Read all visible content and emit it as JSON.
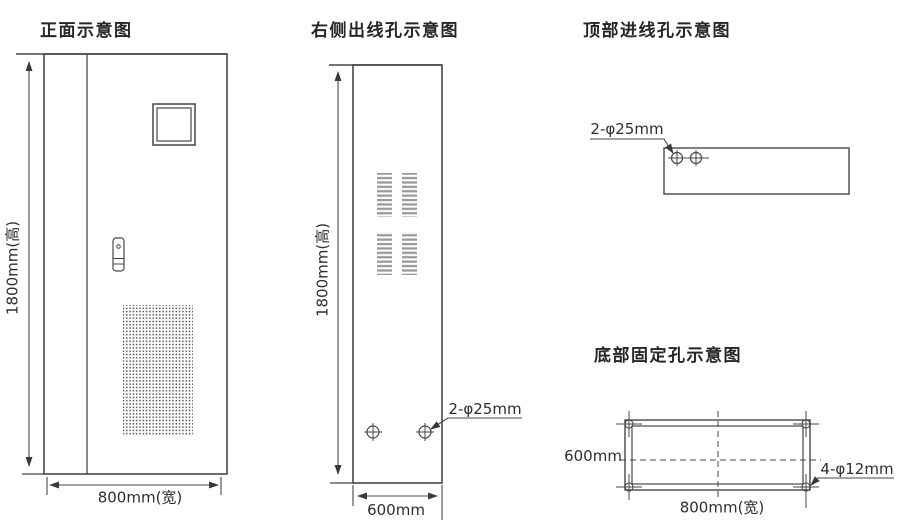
{
  "front_view": {
    "title": "正面示意图",
    "height_dim": "1800mm(高)",
    "width_dim": "800mm(宽)"
  },
  "side_view": {
    "title": "右侧出线孔示意图",
    "height_dim": "1800mm(高)",
    "depth_dim": "600mm",
    "hole_label": "2-φ25mm"
  },
  "top_view": {
    "title": "顶部进线孔示意图",
    "hole_label": "2-φ25mm"
  },
  "bottom_view": {
    "title": "底部固定孔示意图",
    "depth_dim": "600mm",
    "width_dim": "800mm(宽)",
    "hole_label": "4-φ12mm"
  },
  "colors": {
    "line": "#474747",
    "louver_gray": "#9a9a9a",
    "perforation_dot": "#3c3c3c",
    "background": "#ffffff"
  }
}
